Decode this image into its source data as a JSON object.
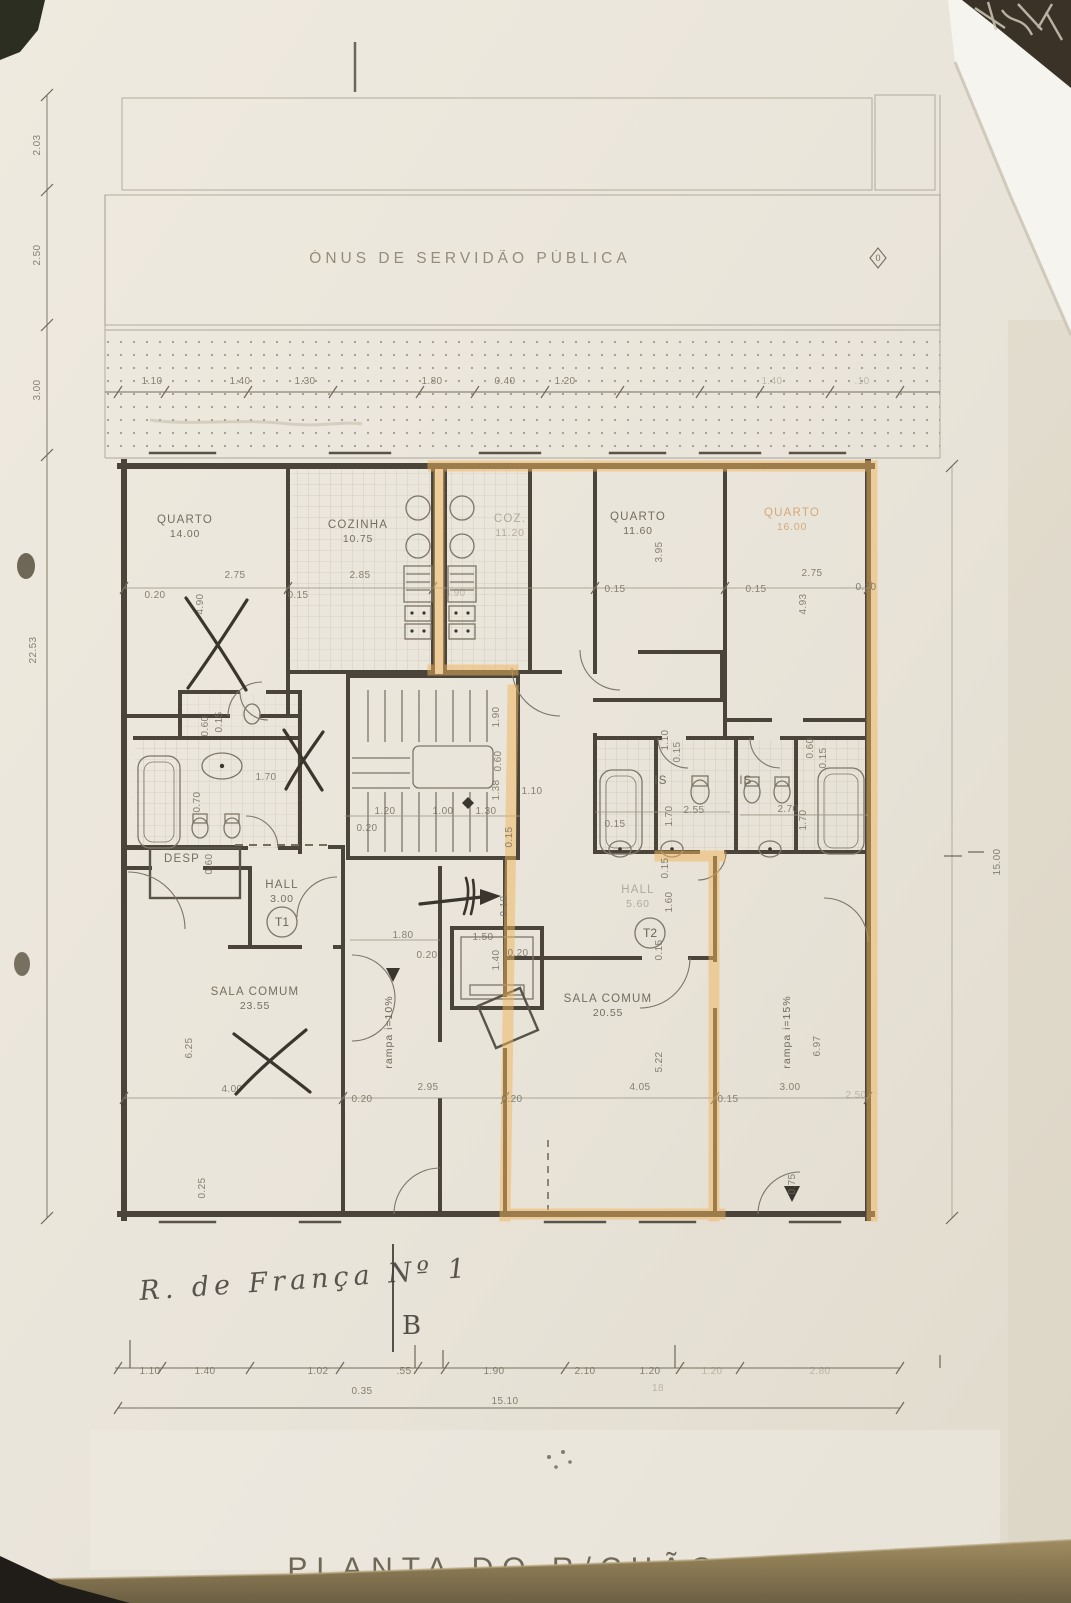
{
  "scene": {
    "servitude_label": "ÓNUS DE SERVIDÃO PÚBLICA",
    "plan_title": "PLANTA DO R/CHÃO",
    "street_note": "R. de França Nº 1",
    "section_letter": "B",
    "zero_marker": "0"
  },
  "colors": {
    "paper": "#e9e4d9",
    "pencil_line": "#756e5e",
    "wall": "#4a443a",
    "highlight": "#f0b55c",
    "table": "#8e7c55",
    "handwriting": "#45413a"
  },
  "rooms": [
    {
      "name": "QUARTO",
      "area": "14.00",
      "x": 185,
      "y": 523
    },
    {
      "name": "COZINHA",
      "area": "10.75",
      "x": 358,
      "y": 528
    },
    {
      "name": "COZ.",
      "area": "11.20",
      "x": 510,
      "y": 522,
      "c": "room-faint"
    },
    {
      "name": "QUARTO",
      "area": "11.60",
      "x": 638,
      "y": 520
    },
    {
      "name": "QUARTO",
      "area": "16.00",
      "x": 792,
      "y": 516,
      "c": "room-orange"
    },
    {
      "name": "SALA COMUM",
      "area": "23.55",
      "x": 255,
      "y": 995
    },
    {
      "name": "SALA COMUM",
      "area": "20.55",
      "x": 608,
      "y": 1002
    },
    {
      "name": "HALL",
      "area": "3.00",
      "x": 282,
      "y": 888
    },
    {
      "name": "HALL",
      "area": "5.60",
      "x": 638,
      "y": 893,
      "c": "room-faint"
    },
    {
      "name": "DESP",
      "area": "",
      "x": 182,
      "y": 862
    },
    {
      "name": "IS",
      "area": "",
      "x": 661,
      "y": 784
    },
    {
      "name": "IS",
      "area": "",
      "x": 746,
      "y": 784
    }
  ],
  "units": [
    {
      "label": "T1",
      "x": 282,
      "y": 922
    },
    {
      "label": "T2",
      "x": 650,
      "y": 933
    }
  ],
  "ramps": [
    {
      "label": "rampa  i=10%",
      "x": 392,
      "y": 1032
    },
    {
      "label": "rampa  i=15%",
      "x": 790,
      "y": 1032
    }
  ],
  "dims": [
    {
      "t": "1.10",
      "x": 152,
      "y": 384
    },
    {
      "t": "1.40",
      "x": 240,
      "y": 384
    },
    {
      "t": "1.30",
      "x": 305,
      "y": 384
    },
    {
      "t": "1.80",
      "x": 432,
      "y": 384
    },
    {
      "t": "0.40",
      "x": 505,
      "y": 384
    },
    {
      "t": "1.20",
      "x": 565,
      "y": 384
    },
    {
      "t": "1.40",
      "x": 772,
      "y": 384,
      "c": "faint"
    },
    {
      "t": ".10",
      "x": 862,
      "y": 384,
      "c": "faint"
    },
    {
      "t": "2.03",
      "x": 40,
      "y": 145,
      "r": -90
    },
    {
      "t": "2.50",
      "x": 40,
      "y": 255,
      "r": -90
    },
    {
      "t": "3.00",
      "x": 40,
      "y": 390,
      "r": -90
    },
    {
      "t": "22.53",
      "x": 36,
      "y": 650,
      "r": -90
    },
    {
      "t": "15.00",
      "x": 1000,
      "y": 862,
      "r": -90
    },
    {
      "t": "0.20",
      "x": 155,
      "y": 598
    },
    {
      "t": "2.75",
      "x": 235,
      "y": 578
    },
    {
      "t": "4.90",
      "x": 203,
      "y": 604,
      "r": -90
    },
    {
      "t": "0.15",
      "x": 298,
      "y": 598
    },
    {
      "t": "2.85",
      "x": 360,
      "y": 578
    },
    {
      "t": "3.90",
      "x": 455,
      "y": 596,
      "c": "faint"
    },
    {
      "t": "0.15",
      "x": 615,
      "y": 592
    },
    {
      "t": "3.95",
      "x": 662,
      "y": 552,
      "r": -90
    },
    {
      "t": "2.75",
      "x": 812,
      "y": 576
    },
    {
      "t": "0.15",
      "x": 756,
      "y": 592
    },
    {
      "t": "0.20",
      "x": 866,
      "y": 590
    },
    {
      "t": "4.93",
      "x": 806,
      "y": 604,
      "r": -90
    },
    {
      "t": "0.60",
      "x": 208,
      "y": 726,
      "r": -90
    },
    {
      "t": "0.15",
      "x": 222,
      "y": 722,
      "r": -90
    },
    {
      "t": "1.70",
      "x": 266,
      "y": 780
    },
    {
      "t": "0.70",
      "x": 200,
      "y": 802,
      "r": -90
    },
    {
      "t": "0.60",
      "x": 212,
      "y": 864,
      "r": -90
    },
    {
      "t": "1.90",
      "x": 499,
      "y": 717,
      "r": -90
    },
    {
      "t": "0.60",
      "x": 501,
      "y": 761,
      "r": -90
    },
    {
      "t": "1.38",
      "x": 499,
      "y": 790,
      "r": -90
    },
    {
      "t": "0.15",
      "x": 512,
      "y": 837,
      "r": -90
    },
    {
      "t": "1.20",
      "x": 385,
      "y": 814
    },
    {
      "t": "1.00",
      "x": 443,
      "y": 814
    },
    {
      "t": "1.30",
      "x": 486,
      "y": 814
    },
    {
      "t": "0.20",
      "x": 367,
      "y": 831
    },
    {
      "t": "1.10",
      "x": 532,
      "y": 794
    },
    {
      "t": "1.10",
      "x": 668,
      "y": 740,
      "r": -90
    },
    {
      "t": "0.15",
      "x": 680,
      "y": 752,
      "r": -90
    },
    {
      "t": "0.15",
      "x": 615,
      "y": 827
    },
    {
      "t": "1.70",
      "x": 672,
      "y": 816,
      "r": -90
    },
    {
      "t": "2.55",
      "x": 694,
      "y": 813
    },
    {
      "t": "0.60",
      "x": 813,
      "y": 748,
      "r": -90
    },
    {
      "t": "0.15",
      "x": 826,
      "y": 758,
      "r": -90
    },
    {
      "t": "2.70",
      "x": 788,
      "y": 812
    },
    {
      "t": "1.70",
      "x": 806,
      "y": 820,
      "r": -90
    },
    {
      "t": "0.15",
      "x": 668,
      "y": 868,
      "r": -90
    },
    {
      "t": "1.60",
      "x": 672,
      "y": 902,
      "r": -90
    },
    {
      "t": "0.15",
      "x": 662,
      "y": 950,
      "r": -90
    },
    {
      "t": "0.10",
      "x": 507,
      "y": 906,
      "r": -90
    },
    {
      "t": "1.80",
      "x": 403,
      "y": 938
    },
    {
      "t": "1.50",
      "x": 483,
      "y": 940
    },
    {
      "t": "0.20",
      "x": 427,
      "y": 958
    },
    {
      "t": "1.40",
      "x": 499,
      "y": 960,
      "r": -90
    },
    {
      "t": "0.20",
      "x": 518,
      "y": 956
    },
    {
      "t": "6.25",
      "x": 192,
      "y": 1048,
      "r": -90
    },
    {
      "t": "4.00",
      "x": 232,
      "y": 1092
    },
    {
      "t": "0.20",
      "x": 362,
      "y": 1102
    },
    {
      "t": "2.95",
      "x": 428,
      "y": 1090
    },
    {
      "t": "0.20",
      "x": 512,
      "y": 1102
    },
    {
      "t": "4.05",
      "x": 640,
      "y": 1090
    },
    {
      "t": "5.22",
      "x": 662,
      "y": 1062,
      "r": -90
    },
    {
      "t": "0.15",
      "x": 728,
      "y": 1102
    },
    {
      "t": "3.00",
      "x": 790,
      "y": 1090
    },
    {
      "t": "6.97",
      "x": 820,
      "y": 1046,
      "r": -90
    },
    {
      "t": "2.50",
      "x": 856,
      "y": 1098,
      "c": "faint"
    },
    {
      "t": "0.75",
      "x": 795,
      "y": 1184,
      "r": -90
    },
    {
      "t": "0.25",
      "x": 205,
      "y": 1188,
      "r": -90
    },
    {
      "t": "1.10",
      "x": 150,
      "y": 1374
    },
    {
      "t": "1.40",
      "x": 205,
      "y": 1374
    },
    {
      "t": "1.02",
      "x": 318,
      "y": 1374
    },
    {
      "t": ".55",
      "x": 404,
      "y": 1374
    },
    {
      "t": "1.90",
      "x": 494,
      "y": 1374
    },
    {
      "t": "2.10",
      "x": 585,
      "y": 1374
    },
    {
      "t": "1.20",
      "x": 650,
      "y": 1374
    },
    {
      "t": "1.20",
      "x": 712,
      "y": 1374,
      "c": "faint"
    },
    {
      "t": "2.80",
      "x": 820,
      "y": 1374,
      "c": "faint"
    },
    {
      "t": "0.35",
      "x": 362,
      "y": 1394
    },
    {
      "t": "18",
      "x": 658,
      "y": 1391,
      "c": "faint"
    },
    {
      "t": "15.10",
      "x": 505,
      "y": 1404
    }
  ]
}
